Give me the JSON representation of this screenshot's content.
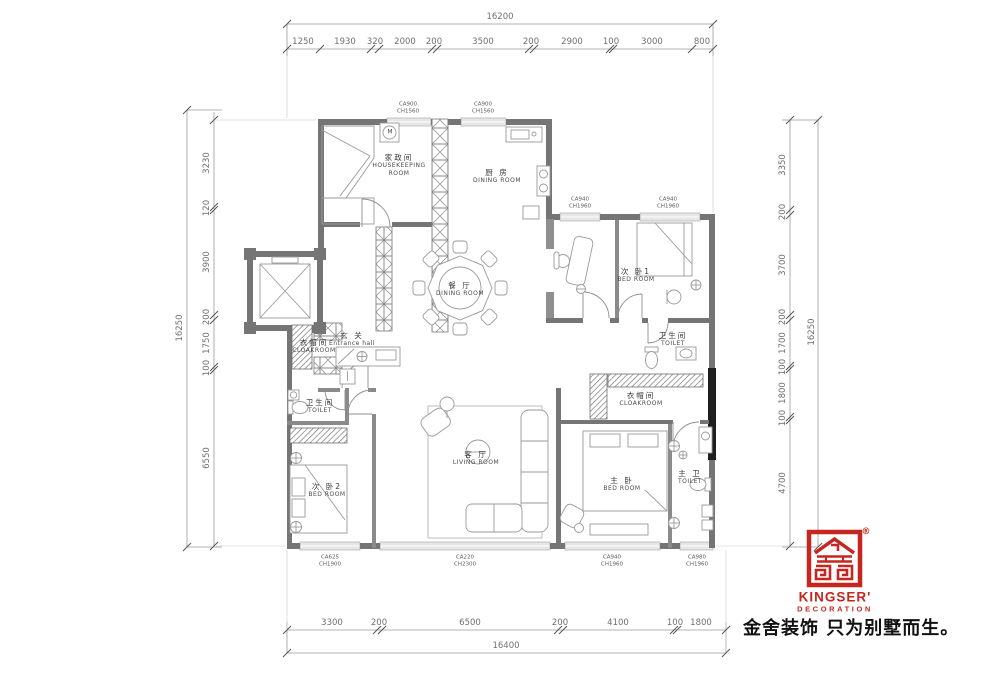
{
  "title": "residential floor plan",
  "colors": {
    "brand_red": "#C5261F",
    "wall": "#757575",
    "dim_text": "#6f6f6f"
  },
  "dims": {
    "top": {
      "total": "16200",
      "segments": [
        "1250",
        "1930",
        "320",
        "2000",
        "200",
        "3500",
        "200",
        "2900",
        "100",
        "3000",
        "800"
      ]
    },
    "bottom": {
      "total": "16400",
      "segments": [
        "3300",
        "200",
        "6500",
        "200",
        "4100",
        "100",
        "1800"
      ]
    },
    "left": {
      "total": "16250",
      "segments": [
        "3230",
        "120",
        "3900",
        "200",
        "1750",
        "100",
        "6550"
      ]
    },
    "right": {
      "total": "16250",
      "segments": [
        "3350",
        "200",
        "3700",
        "200",
        "1700",
        "100",
        "1800",
        "100",
        "4700"
      ]
    }
  },
  "rooms": {
    "housekeeping": {
      "cn": "家政间",
      "en1": "HOUSEKEEPING",
      "en2": "ROOM"
    },
    "kitchen": {
      "cn": "厨 房",
      "en": "DINING ROOM"
    },
    "dining": {
      "cn": "餐 厅",
      "en": "DINING ROOM"
    },
    "bedroom1": {
      "cn": "次 卧1",
      "en": "BED ROOM"
    },
    "toilet1": {
      "cn": "卫生间",
      "en": "TOILET"
    },
    "entrance": {
      "cn": "玄 关",
      "en": "Entrance hall"
    },
    "cloakroom_left": {
      "cn": "衣帽间",
      "en": "CLOAKROOM"
    },
    "cloakroom_right": {
      "cn": "衣帽间",
      "en": "CLOAKROOM"
    },
    "toilet2": {
      "cn": "卫生间",
      "en": "TOILET"
    },
    "bedroom2": {
      "cn": "次 卧2",
      "en": "BED ROOM"
    },
    "living": {
      "cn": "客 厅",
      "en": "LIVING ROOM"
    },
    "master_bedroom": {
      "cn": "主 卧",
      "en": "BED ROOM"
    },
    "master_toilet": {
      "cn": "主 卫",
      "en": "TOILET"
    }
  },
  "windows": {
    "t1": [
      "CA900",
      "CH1560"
    ],
    "t2": [
      "CA900",
      "CH1560"
    ],
    "t3": [
      "CA940",
      "CH1960"
    ],
    "t4": [
      "CA940",
      "CH1960"
    ],
    "b1": [
      "CA625",
      "CH1900"
    ],
    "b2": [
      "CA220",
      "CH2300"
    ],
    "b3": [
      "CA940",
      "CH1960"
    ],
    "b4": [
      "CA980",
      "CH1960"
    ]
  },
  "washer_label": "M",
  "brand": {
    "name": "KINGSER'",
    "sub": "DECORATION",
    "reg": "®",
    "slogan": "金舍装饰 只为别墅而生。"
  }
}
